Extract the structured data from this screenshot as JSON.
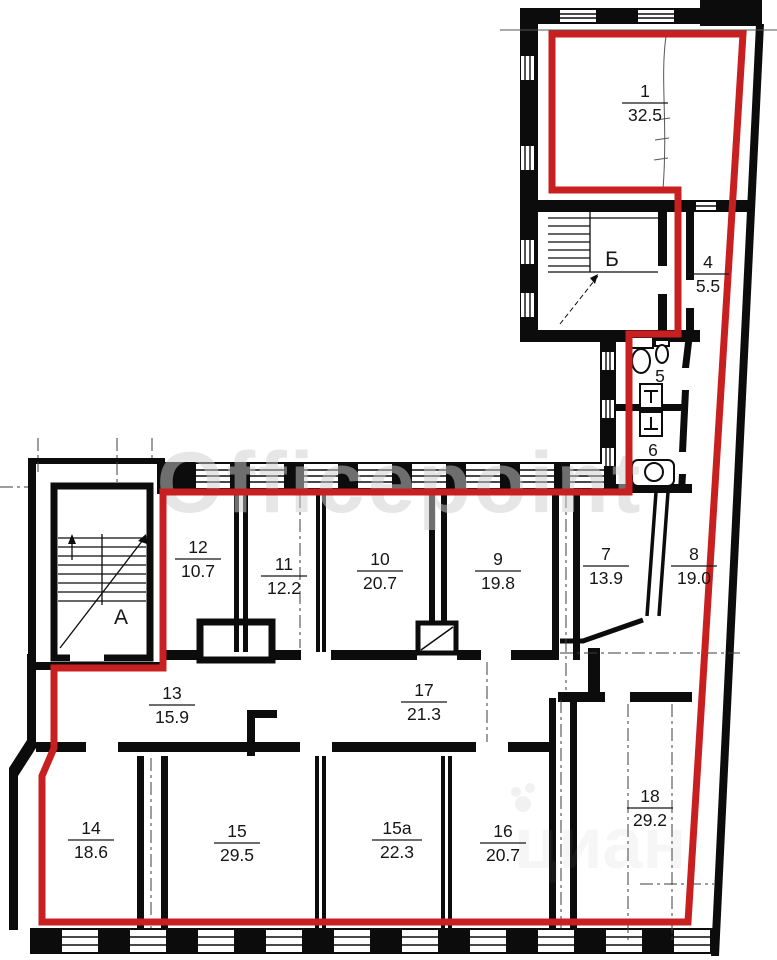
{
  "drawing": {
    "type": "floor-plan",
    "boundary_color": "#c82020",
    "wall_color": "#0c0c0c"
  },
  "watermarks": {
    "primary": "Officepoint",
    "secondary": "циан"
  },
  "stairwells": [
    {
      "label": "А"
    },
    {
      "label": "Б"
    }
  ],
  "rooms": [
    {
      "number": "1",
      "area": "32.5"
    },
    {
      "number": "4",
      "area": "5.5"
    },
    {
      "number": "5",
      "area": ""
    },
    {
      "number": "6",
      "area": ""
    },
    {
      "number": "7",
      "area": "13.9"
    },
    {
      "number": "8",
      "area": "19.0"
    },
    {
      "number": "9",
      "area": "19.8"
    },
    {
      "number": "10",
      "area": "20.7"
    },
    {
      "number": "11",
      "area": "12.2"
    },
    {
      "number": "12",
      "area": "10.7"
    },
    {
      "number": "13",
      "area": "15.9"
    },
    {
      "number": "14",
      "area": "18.6"
    },
    {
      "number": "15",
      "area": "29.5"
    },
    {
      "number": "15a",
      "area": "22.3"
    },
    {
      "number": "16",
      "area": "20.7"
    },
    {
      "number": "17",
      "area": "21.3"
    },
    {
      "number": "18",
      "area": "29.2"
    }
  ]
}
